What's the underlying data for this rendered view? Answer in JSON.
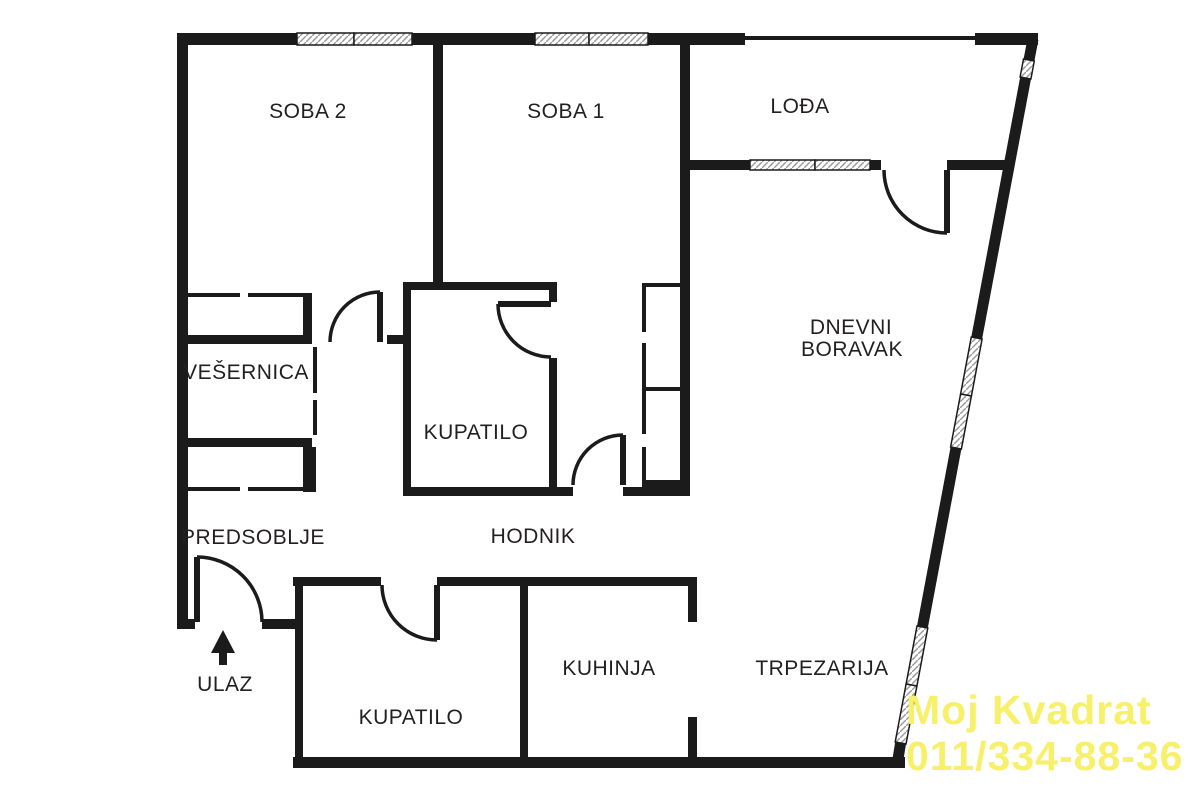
{
  "floorplan": {
    "title": "Apartment floor plan",
    "rooms": {
      "soba2": "SOBA 2",
      "soba1": "SOBA 1",
      "lodja": "LOĐA",
      "dnevni_line1": "DNEVNI",
      "dnevni_line2": "BORAVAK",
      "vesernica": "VEŠERNICA",
      "kupatilo_upper": "KUPATILO",
      "predsoblje": "PREDSOBLJE",
      "hodnik": "HODNIK",
      "kupatilo_lower": "KUPATILO",
      "kuhinja": "KUHINJA",
      "trpezarija": "TRPEZARIJA"
    },
    "entrance_label": "ULAZ",
    "icons": {
      "entrance_arrow": "arrow-up-icon"
    },
    "watermark": {
      "line1": "Moj Kvadrat",
      "line2": "011/334-88-36",
      "color": "#f7f06a"
    },
    "colors": {
      "wall": "#1b1b1b",
      "text": "#231f20",
      "background": "#ffffff",
      "window_hatch": "#9a9a9a"
    }
  }
}
